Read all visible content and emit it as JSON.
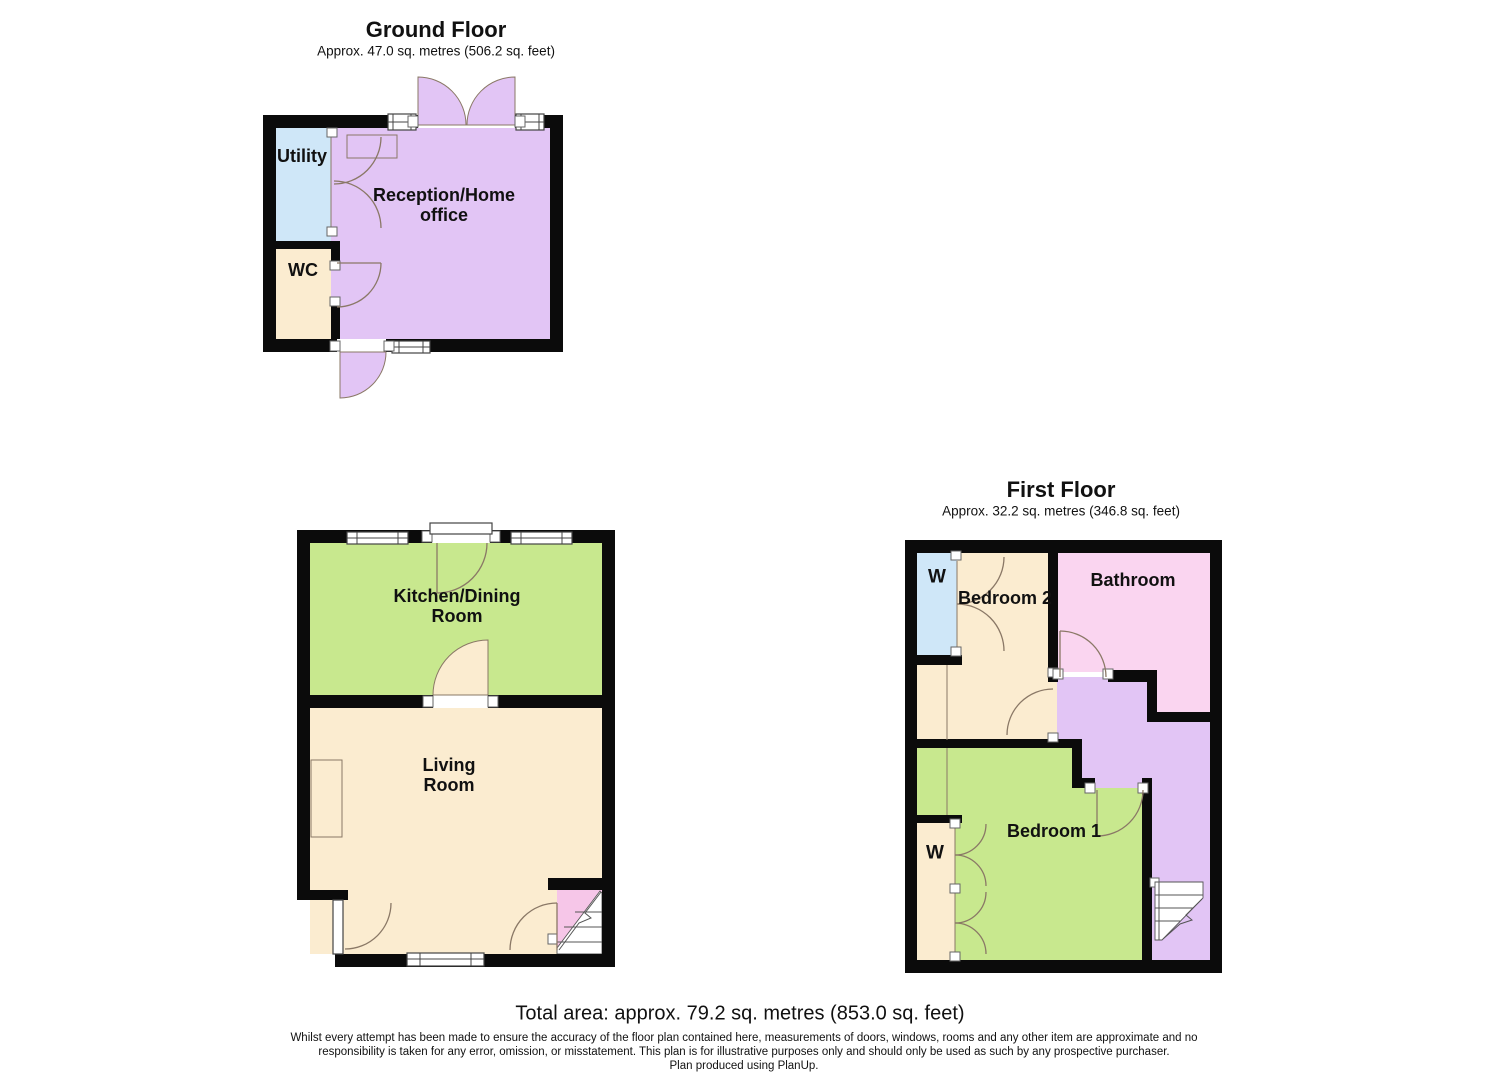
{
  "colors": {
    "wall": "#0b0b0b",
    "purple": "#e2c5f5",
    "blue": "#cfe7f8",
    "cream": "#fbecd0",
    "green": "#c8e88e",
    "pink": "#fad5f0",
    "stair_pink": "#f6c6e8",
    "door": "#8a7866",
    "window": "#444444"
  },
  "ground_floor": {
    "title": "Ground Floor",
    "area": "Approx. 47.0 sq. metres (506.2 sq. feet)",
    "rooms": {
      "utility": {
        "label": "Utility"
      },
      "wc": {
        "label": "WC"
      },
      "reception": {
        "lines": [
          "Reception/Home",
          "office"
        ]
      },
      "kitchen": {
        "lines": [
          "Kitchen/Dining",
          "Room"
        ]
      },
      "living": {
        "lines": [
          "Living",
          "Room"
        ]
      }
    }
  },
  "first_floor": {
    "title": "First Floor",
    "area": "Approx. 32.2 sq. metres (346.8 sq. feet)",
    "rooms": {
      "wardrobe_top": {
        "label": "W"
      },
      "bedroom2": {
        "label": "Bedroom 2"
      },
      "bathroom": {
        "label": "Bathroom"
      },
      "bedroom1": {
        "label": "Bedroom 1"
      },
      "wardrobe_bottom": {
        "label": "W"
      }
    }
  },
  "footer": {
    "total_area": "Total area: approx. 79.2 sq. metres (853.0 sq. feet)",
    "disclaimer": [
      "Whilst every attempt has been made to ensure the accuracy of the floor plan contained here, measurements of doors, windows, rooms and any other item are approximate and no",
      "responsibility is taken for any error, omission, or misstatement. This plan is for illustrative purposes only and should only be used as such by any prospective purchaser.",
      "Plan produced using PlanUp."
    ]
  }
}
